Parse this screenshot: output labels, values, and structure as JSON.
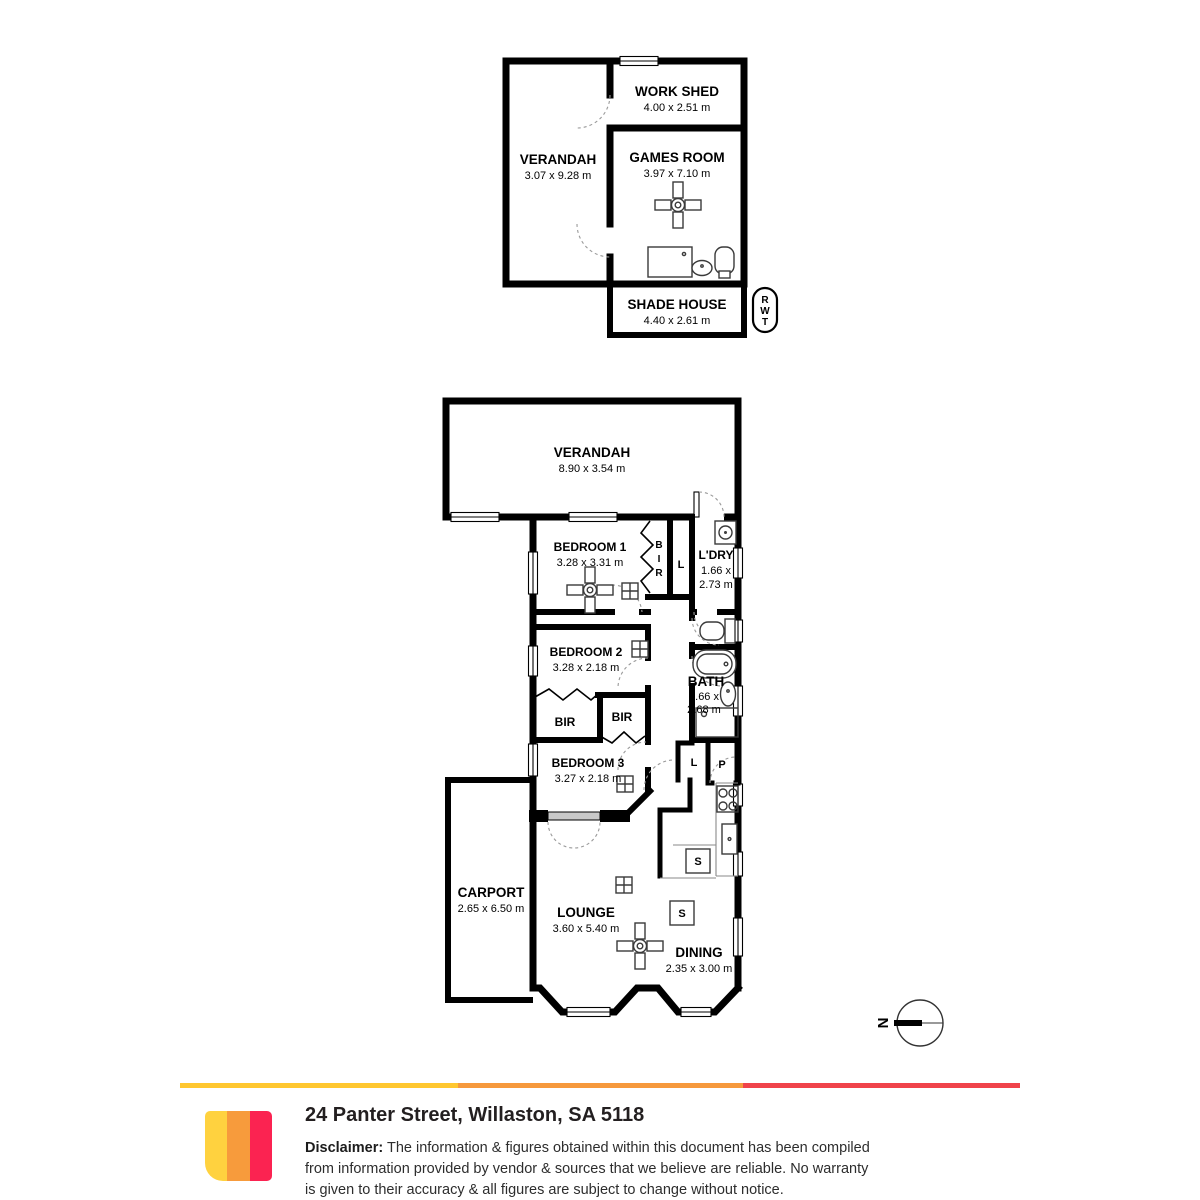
{
  "document": {
    "background": "#ffffff",
    "line_color": "#000000"
  },
  "outbuilding": {
    "verandah": {
      "name": "VERANDAH",
      "dims": "3.07 x 9.28 m"
    },
    "work_shed": {
      "name": "WORK SHED",
      "dims": "4.00 x 2.51 m"
    },
    "games_room": {
      "name": "GAMES ROOM",
      "dims": "3.97 x 7.10 m"
    },
    "shade_house": {
      "name": "SHADE HOUSE",
      "dims": "4.40 x 2.61 m"
    },
    "rwt": {
      "l1": "R",
      "l2": "W",
      "l3": "T"
    }
  },
  "house": {
    "verandah": {
      "name": "VERANDAH",
      "dims": "8.90 x 3.54 m"
    },
    "bedroom1": {
      "name": "BEDROOM 1",
      "dims": "3.28 x 3.31 m"
    },
    "bir_bedroom1": {
      "l1": "B",
      "l2": "I",
      "l3": "R"
    },
    "linen1": {
      "label": "L"
    },
    "laundry": {
      "name": "L'DRY",
      "dim1": "1.66 x",
      "dim2": "2.73 m"
    },
    "bedroom2": {
      "name": "BEDROOM 2",
      "dims": "3.28 x 2.18 m"
    },
    "bath": {
      "name": "BATH",
      "dim1": "1.66 x",
      "dim2": "2.68 m"
    },
    "bir_left": {
      "label": "BIR"
    },
    "bir_right": {
      "label": "BIR"
    },
    "bedroom3": {
      "name": "BEDROOM 3",
      "dims": "3.27 x 2.18 m"
    },
    "linen2": {
      "label": "L"
    },
    "pantry": {
      "label": "P"
    },
    "sink_box1": {
      "label": "S"
    },
    "sink_box2": {
      "label": "S"
    },
    "carport": {
      "name": "CARPORT",
      "dims": "2.65 x 6.50 m"
    },
    "lounge": {
      "name": "LOUNGE",
      "dims": "3.60 x 5.40 m"
    },
    "dining": {
      "name": "DINING",
      "dims": "2.35 x 3.00 m"
    }
  },
  "compass": {
    "north": "N"
  },
  "footer": {
    "address": "24 Panter Street, Willaston, SA 5118",
    "disclaimer_label": "Disclaimer:",
    "disclaimer_line1": "The information & figures obtained within this document has been compiled",
    "disclaimer_line2": "from information provided by vendor & sources that we believe are reliable. No warranty",
    "disclaimer_line3": "is given to their accuracy & all figures are subject to change without notice.",
    "brand": {
      "bar_colors": [
        "#FFC72F",
        "#F6993C",
        "#F0434A"
      ],
      "logo_colors": [
        "#FFD23F",
        "#F79B3C",
        "#FB2351"
      ]
    }
  }
}
